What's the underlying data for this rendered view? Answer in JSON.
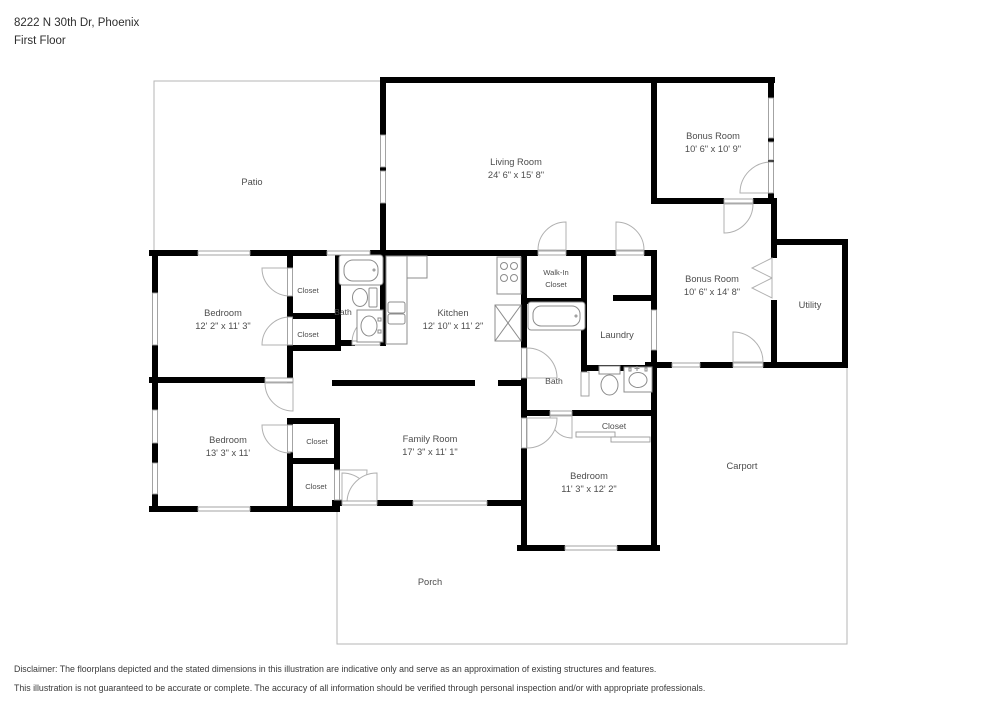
{
  "header": {
    "address": "8222 N 30th Dr, Phoenix",
    "floor": "First Floor"
  },
  "rooms": [
    {
      "id": "patio",
      "lines": [
        "Patio"
      ]
    },
    {
      "id": "living-room",
      "lines": [
        "Living Room",
        "24' 6\" x 15' 8\""
      ]
    },
    {
      "id": "bonus-room-1",
      "lines": [
        "Bonus Room",
        "10' 6\" x 10' 9\""
      ]
    },
    {
      "id": "bonus-room-2",
      "lines": [
        "Bonus Room",
        "10' 6\" x 14' 8\""
      ]
    },
    {
      "id": "utility",
      "lines": [
        "Utility"
      ]
    },
    {
      "id": "bedroom-1",
      "lines": [
        "Bedroom",
        "12' 2\" x 11' 3\""
      ]
    },
    {
      "id": "closet-a",
      "lines": [
        "Closet"
      ]
    },
    {
      "id": "bath-1",
      "lines": [
        "Bath"
      ]
    },
    {
      "id": "closet-b",
      "lines": [
        "Closet"
      ]
    },
    {
      "id": "kitchen",
      "lines": [
        "Kitchen",
        "12' 10\" x 11' 2\""
      ]
    },
    {
      "id": "walk-in-closet",
      "lines": [
        "Walk-In",
        "Closet"
      ]
    },
    {
      "id": "laundry",
      "lines": [
        "Laundry"
      ]
    },
    {
      "id": "bath-2",
      "lines": [
        "Bath"
      ]
    },
    {
      "id": "bedroom-2",
      "lines": [
        "Bedroom",
        "13' 3\" x 11'"
      ]
    },
    {
      "id": "closet-c",
      "lines": [
        "Closet"
      ]
    },
    {
      "id": "family-room",
      "lines": [
        "Family Room",
        "17' 3\" x 11' 1\""
      ]
    },
    {
      "id": "closet-d",
      "lines": [
        "Closet"
      ]
    },
    {
      "id": "closet-e",
      "lines": [
        "Closet"
      ]
    },
    {
      "id": "bedroom-3",
      "lines": [
        "Bedroom",
        "11' 3\" x 12' 2\""
      ]
    },
    {
      "id": "carport",
      "lines": [
        "Carport"
      ]
    },
    {
      "id": "porch",
      "lines": [
        "Porch"
      ]
    }
  ],
  "disclaimer": {
    "line1": "Disclaimer: The floorplans depicted and the stated dimensions in this illustration are indicative only and serve as an approximation of existing structures and features.",
    "line2": "This illustration is not guaranteed to be accurate or complete. The accuracy of all information should be verified through personal inspection and/or with appropriate professionals."
  },
  "colors": {
    "wall": "#000000",
    "label": "#4d4d4d",
    "outdoor_outline": "#b5b5b5",
    "fixture_stroke": "#8c8c8c",
    "background": "#ffffff"
  }
}
